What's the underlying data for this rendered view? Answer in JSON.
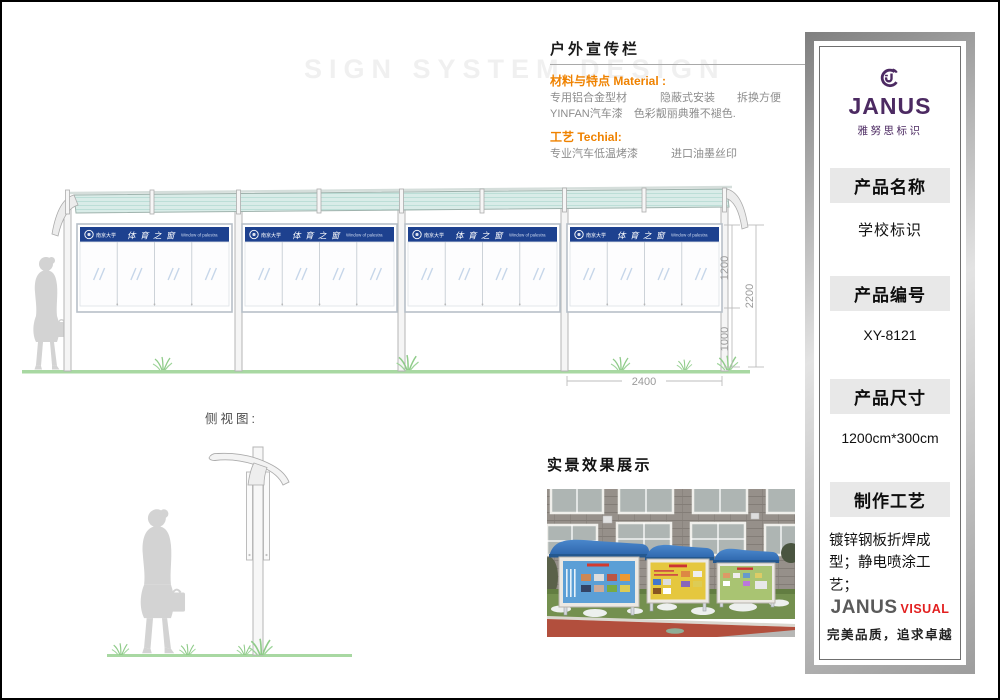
{
  "watermark": "SIGN SYSTEM DESIGN",
  "info": {
    "title": "户外宣传栏",
    "material_label": "材料与特点 Material :",
    "material_line1": "专用铝合金型材　　　隐蔽式安装　　拆换方便",
    "material_line2": "YINFAN汽车漆　色彩靓丽典雅不褪色.",
    "tech_label": "工艺 Techial:",
    "tech_line1": "专业汽车低温烤漆　　　进口油墨丝印"
  },
  "drawing": {
    "board_org": "南京大学",
    "board_title": "体育之窗",
    "board_subtitle": "Window of palestra",
    "dims": {
      "board_height": "1200",
      "total_height": "2200",
      "ground_clearance": "1000",
      "bay_width": "2400"
    }
  },
  "side_view": {
    "label": "侧视图:"
  },
  "photo": {
    "label": "实景效果展示"
  },
  "sidebar": {
    "logo_text": "JANUS",
    "logo_sub": "雅努思标识",
    "sections": [
      {
        "header": "产品名称",
        "value": "学校标识"
      },
      {
        "header": "产品编号",
        "value": "XY-8121"
      },
      {
        "header": "产品尺寸",
        "value": "1200cm*300cm"
      },
      {
        "header": "制作工艺",
        "value": "镀锌钢板折焊成型；静电喷涂工艺；"
      }
    ],
    "footer_brand": "JANUS",
    "footer_brand2": "VISUAL",
    "footer_tagline": "完美品质，追求卓越"
  },
  "colors": {
    "accent_orange": "#ef8200",
    "board_header_blue": "#1d418f",
    "roof_teal": "#d9ece8",
    "grass_green": "#a8d8a2",
    "silhouette_gray": "#d3d3d3",
    "brand_purple": "#4c2a62",
    "brand_red": "#e21f1f",
    "dim_gray": "#9a9a9a"
  }
}
